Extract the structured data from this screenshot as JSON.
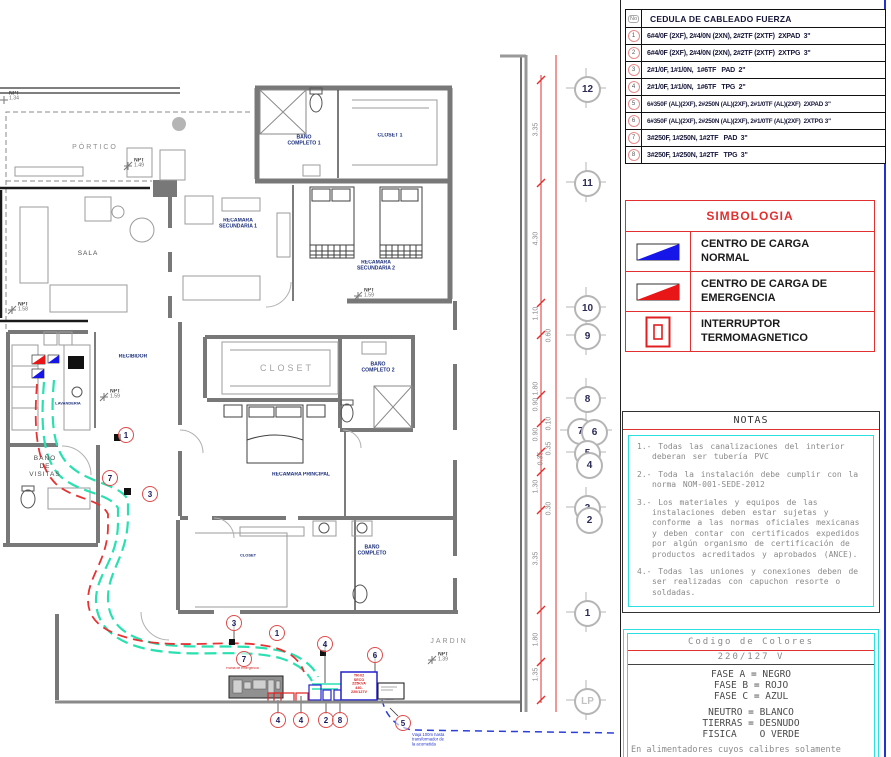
{
  "colors": {
    "accent_red": "#e03030",
    "accent_cyan": "#2ae0e0",
    "cc_normal_blue": "#1616e8",
    "cc_emergency_red": "#e81616",
    "route_cyan": "#2ae0b0",
    "route_red": "#e53333",
    "route_blue": "#2b3fd6"
  },
  "cedula": {
    "no_header": "No",
    "title": "CEDULA DE CABLEADO FUERZA",
    "rows": [
      {
        "no": "1",
        "text": "6#4/0F (2XF), 2#4/0N (2XN), 2#2TF (2XTF)  2XPAD  3\""
      },
      {
        "no": "2",
        "text": "6#4/0F (2XF), 2#4/0N (2XN), 2#2TF (2XTF)  2XTPG  3\""
      },
      {
        "no": "3",
        "text": "2#1/0F, 1#1/0N,  1#6TF   PAD  2\""
      },
      {
        "no": "4",
        "text": "2#1/0F, 1#1/0N,  1#6TF   TPG  2\""
      },
      {
        "no": "5",
        "text": "6#350F (AL)(2XF), 2#250N (AL)(2XF), 2#1/0TF (AL)(2XF)  2XPAD 3\""
      },
      {
        "no": "6",
        "text": "6#350F (AL)(2XF), 2#250N (AL)(2XF), 2#1/0TF (AL)(2XF)  2XTPG 3\""
      },
      {
        "no": "7",
        "text": "3#250F, 1#250N, 1#2TF   PAD  3\""
      },
      {
        "no": "8",
        "text": "3#250F, 1#250N, 1#2TF   TPG  3\""
      }
    ]
  },
  "simbologia": {
    "title": "SIMBOLOGIA",
    "items": [
      {
        "symbol": "centro-carga-normal",
        "label": "CENTRO DE CARGA NORMAL"
      },
      {
        "symbol": "centro-carga-emergencia",
        "label": "CENTRO DE CARGA DE EMERGENCIA"
      },
      {
        "symbol": "interruptor-termomagnetico",
        "label": "INTERRUPTOR TERMOMAGNETICO"
      }
    ]
  },
  "notas": {
    "title": "NOTAS",
    "items": [
      "1.- Todas las canalizaciones del interior deberan ser tubería PVC",
      "2.- Toda la instalación debe cumplir con la norma NOM-001-SEDE-2012",
      "3.- Los materiales y equipos de las instalaciones deben estar sujetas y conforme a las normas oficiales mexicanas y deben contar con certificados expedidos por algún organismo de certificación de productos acreditados y aprobados (ANCE).",
      "4.- Todas las uniones y conexiones deben de ser realizadas con capuchon resorte o soldadas."
    ]
  },
  "codigo": {
    "title": "Codigo de Colores",
    "voltage": "220/127 V",
    "fases": [
      "FASE A = NEGRO",
      "FASE B = ROJO",
      "FASE C = AZUL"
    ],
    "otros": [
      "NEUTRO = BLANCO",
      "TIERRAS = DESNUDO",
      "FISICA    O VERDE"
    ],
    "footer": "En alimentadores cuyos calibres solamente"
  },
  "grid": [
    "12",
    "11",
    "10",
    "9",
    "8",
    "7",
    "6",
    "5",
    "4",
    "3",
    "2",
    "1",
    "LP"
  ],
  "dims": [
    "3.35",
    "4.30",
    "1.10",
    "0.60",
    "1.80",
    "0.90",
    "0.10",
    "0.90",
    "0.35",
    "0.35",
    "1.30",
    "0.30",
    "3.35",
    "1.80",
    "1.35"
  ],
  "plan": {
    "rooms": [
      {
        "t": "PÓRTICO"
      },
      {
        "t": "SALA"
      },
      {
        "t": "RECAMARA\nSECUNDARIA 1"
      },
      {
        "t": "RECAMARA\nSECUNDARIA 2"
      },
      {
        "t": "BAÑO\nCOMPLETO 1"
      },
      {
        "t": "CLOSET 1"
      },
      {
        "t": "RECIBIDOR"
      },
      {
        "t": "LAVANDERIA"
      },
      {
        "t": "BAÑO\nDE\nVISITAS"
      },
      {
        "t": "CLOSET"
      },
      {
        "t": "BAÑO\nCOMPLETO 2"
      },
      {
        "t": "RECAMARA PRINCIPAL"
      },
      {
        "t": "CLOSET"
      },
      {
        "t": "BAÑO\nCOMPLETO"
      },
      {
        "t": "JARDIN"
      }
    ],
    "npts": [
      {
        "label": "NPT",
        "value": "1.34"
      },
      {
        "label": "NPT",
        "value": "1.49"
      },
      {
        "label": "NPT",
        "value": "1.58"
      },
      {
        "label": "NPT",
        "value": "1.59"
      },
      {
        "label": "NPT",
        "value": "1.59"
      },
      {
        "label": "NPT",
        "value": "1.39"
      }
    ],
    "circuits": [
      {
        "n": "1"
      },
      {
        "n": "7"
      },
      {
        "n": "3"
      },
      {
        "n": "3"
      },
      {
        "n": "1"
      },
      {
        "n": "7"
      },
      {
        "n": "4"
      },
      {
        "n": "6"
      },
      {
        "n": "4"
      },
      {
        "n": "4"
      },
      {
        "n": "2"
      },
      {
        "n": "8"
      },
      {
        "n": "5"
      }
    ],
    "equipment": {
      "tr_lines": [
        "TR-02",
        "SECO",
        "225KVA",
        "440-220/127V"
      ],
      "planta_label": "Planta de emergencia",
      "acometida_note": "Viaja 100m hasta\ntransformador de\nla acometida"
    }
  }
}
